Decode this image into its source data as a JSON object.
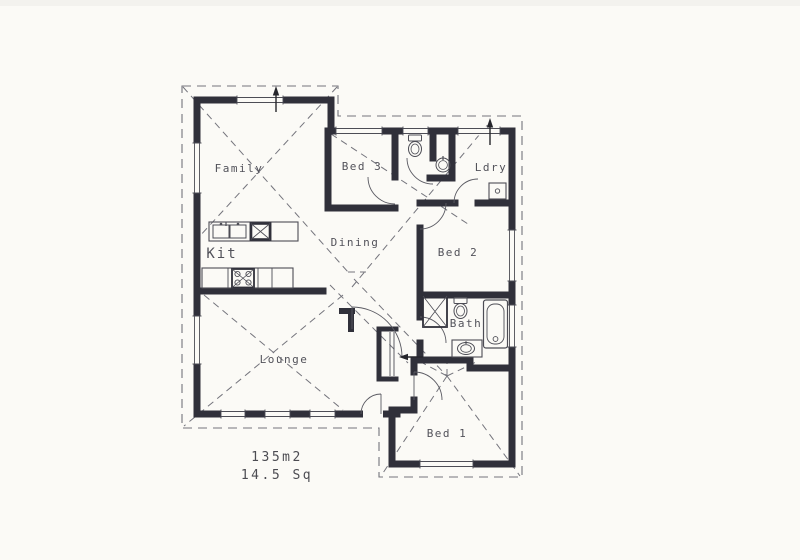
{
  "plan": {
    "rooms": {
      "family": "Family",
      "bed3": "Bed 3",
      "ldry": "Ldry",
      "kit": "Kit",
      "dining": "Dining",
      "bed2": "Bed 2",
      "bath": "Bath",
      "lounge": "Lounge",
      "bed1": "Bed 1"
    },
    "area": {
      "m2": "135m2",
      "squares": "14.5 Sq"
    },
    "colors": {
      "paper": "#fbfaf6",
      "wall": "#30303a",
      "thin_line": "#4d4d55",
      "roof_dash": "#74747c",
      "label": "#52525a"
    }
  }
}
